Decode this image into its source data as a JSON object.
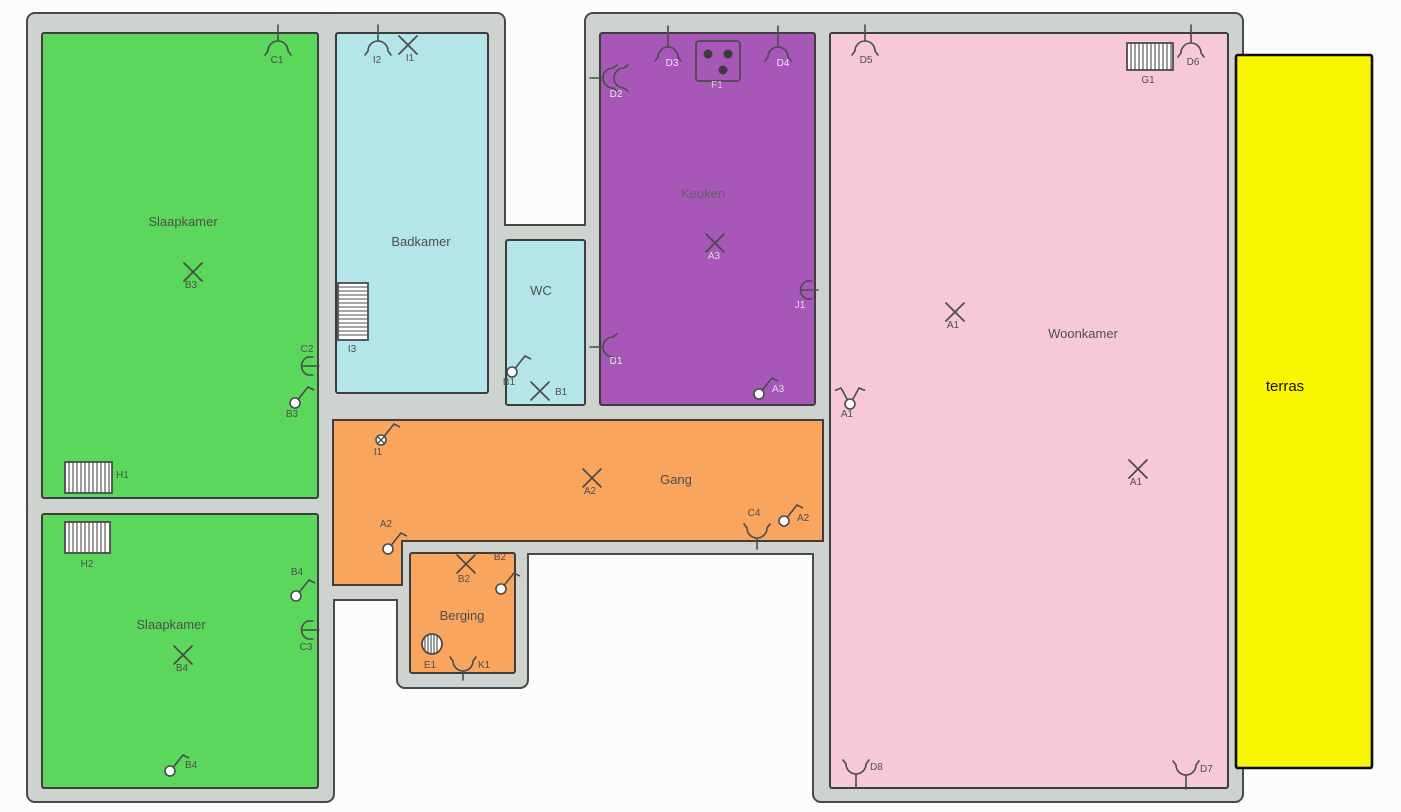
{
  "plan": {
    "title": "floor-plan",
    "colors": {
      "wall": "#cfd3cf",
      "wallStroke": "#4a4a45",
      "roomStroke": "#3d3d3d",
      "green": "#5bd75b",
      "cyan": "#b4e5e9",
      "purple": "#a757b7",
      "pink": "#f6c8d8",
      "orange": "#f9a55e",
      "yellow": "#f8f500",
      "symbol": "#4b4b4b",
      "label": "#4f4f4f"
    },
    "walls": [
      {
        "x": 28,
        "y": 14,
        "w": 305,
        "h": 497
      },
      {
        "x": 322,
        "y": 14,
        "w": 182,
        "h": 395
      },
      {
        "x": 494,
        "y": 226,
        "w": 104,
        "h": 193
      },
      {
        "x": 320,
        "y": 406,
        "w": 518,
        "h": 147
      },
      {
        "x": 320,
        "y": 500,
        "w": 96,
        "h": 99
      },
      {
        "x": 398,
        "y": 539,
        "w": 129,
        "h": 148
      },
      {
        "x": 28,
        "y": 500,
        "w": 305,
        "h": 301
      },
      {
        "x": 586,
        "y": 14,
        "w": 258,
        "h": 407
      },
      {
        "x": 814,
        "y": 14,
        "w": 428,
        "h": 787
      }
    ],
    "rooms": [
      {
        "id": "slaapkamer-1",
        "label": "Slaapkamer",
        "shape": "rect",
        "x": 42,
        "y": 33,
        "w": 276,
        "h": 465,
        "fill": "green",
        "lx": 183,
        "ly": 226
      },
      {
        "id": "badkamer",
        "label": "Badkamer",
        "shape": "rect",
        "x": 336,
        "y": 33,
        "w": 152,
        "h": 360,
        "fill": "cyan",
        "lx": 421,
        "ly": 246
      },
      {
        "id": "wc",
        "label": "WC",
        "shape": "rect",
        "x": 506,
        "y": 240,
        "w": 79,
        "h": 165,
        "fill": "cyan",
        "lx": 541,
        "ly": 295
      },
      {
        "id": "keuken",
        "label": "Keuken",
        "shape": "rect",
        "x": 600,
        "y": 33,
        "w": 215,
        "h": 372,
        "fill": "purple",
        "lx": 703,
        "ly": 198,
        "lc": "#616161"
      },
      {
        "id": "woonkamer",
        "label": "Woonkamer",
        "shape": "rect",
        "x": 830,
        "y": 33,
        "w": 398,
        "h": 755,
        "fill": "pink",
        "lx": 1083,
        "ly": 338
      },
      {
        "id": "gang",
        "label": "Gang",
        "shape": "poly",
        "points": "333,420 823,420 823,541 402,541 402,585 333,585",
        "fill": "orange",
        "lx": 676,
        "ly": 484
      },
      {
        "id": "berging",
        "label": "Berging",
        "shape": "rect",
        "x": 410,
        "y": 553,
        "w": 105,
        "h": 120,
        "fill": "orange",
        "lx": 462,
        "ly": 620
      },
      {
        "id": "slaapkamer-2",
        "label": "Slaapkamer",
        "shape": "rect",
        "x": 42,
        "y": 514,
        "w": 276,
        "h": 274,
        "fill": "green",
        "lx": 171,
        "ly": 629
      },
      {
        "id": "terras",
        "label": "terras",
        "shape": "rect",
        "x": 1236,
        "y": 55,
        "w": 136,
        "h": 713,
        "fill": "yellow",
        "stroke": "#0d0d0d",
        "sw": 2.6,
        "lx": 1285,
        "ly": 391,
        "fs": 15,
        "lc": "#111111"
      }
    ],
    "symbols": [
      {
        "t": "ceiling-lamp",
        "x": 278,
        "y": 49,
        "stem": 16,
        "label": "C1",
        "lx": 277,
        "ly": 63
      },
      {
        "t": "lamp-x",
        "x": 193,
        "y": 272,
        "label": "B3",
        "lx": 191,
        "ly": 288
      },
      {
        "t": "socket",
        "x": 305,
        "y": 366,
        "label": "C2",
        "lx": 307,
        "ly": 352
      },
      {
        "t": "switch",
        "x": 295,
        "y": 403,
        "label": "B3",
        "lx": 292,
        "ly": 417
      },
      {
        "t": "radiator",
        "x": 65,
        "y": 462,
        "w": 47,
        "h": 31,
        "hatch": "v",
        "label": "H1",
        "lx": 116,
        "ly": 478,
        "anchor": "start"
      },
      {
        "t": "ceiling-lamp",
        "x": 378,
        "y": 49,
        "stem": 16,
        "label": "I2",
        "lx": 377,
        "ly": 63
      },
      {
        "t": "lamp-x",
        "x": 408,
        "y": 45,
        "label": "I1",
        "lx": 410,
        "ly": 61
      },
      {
        "t": "radiator",
        "x": 338,
        "y": 283,
        "w": 30,
        "h": 57,
        "hatch": "h",
        "label": "I3",
        "lx": 352,
        "ly": 352
      },
      {
        "t": "switch",
        "x": 512,
        "y": 372,
        "label": "B1",
        "lx": 509,
        "ly": 385
      },
      {
        "t": "lamp-x",
        "x": 540,
        "y": 391,
        "label": "B1",
        "lx": 555,
        "ly": 395,
        "anchor": "start"
      },
      {
        "t": "wall-lamp-double",
        "x": 611,
        "y": 78,
        "rot": -90,
        "label": "D2",
        "lx": 616,
        "ly": 97,
        "lc": "#e9e9e9"
      },
      {
        "t": "ceiling-lamp",
        "x": 668,
        "y": 55,
        "stem": 21,
        "label": "D3",
        "lx": 672,
        "ly": 66,
        "lc": "#e9e9e9"
      },
      {
        "t": "cooktop",
        "x": 696,
        "y": 41,
        "w": 44,
        "h": 40,
        "label": "F1",
        "lx": 717,
        "ly": 88,
        "lc": "#cfcfcf"
      },
      {
        "t": "ceiling-lamp",
        "x": 778,
        "y": 55,
        "stem": 21,
        "label": "D4",
        "lx": 783,
        "ly": 66,
        "lc": "#e9e9e9"
      },
      {
        "t": "lamp-x",
        "x": 715,
        "y": 243,
        "label": "A3",
        "lx": 714,
        "ly": 259,
        "lc": "#dcdcdc"
      },
      {
        "t": "socket",
        "x": 804,
        "y": 290,
        "label": "J1",
        "lx": 800,
        "ly": 308,
        "lc": "#dcdcdc"
      },
      {
        "t": "wall-lamp",
        "x": 611,
        "y": 347,
        "rot": -90,
        "label": "D1",
        "lx": 616,
        "ly": 364,
        "lc": "#e9e9e9"
      },
      {
        "t": "switch",
        "x": 759,
        "y": 394,
        "label": "A3",
        "lx": 772,
        "ly": 392,
        "anchor": "start",
        "lc": "#dcdcdc"
      },
      {
        "t": "ceiling-lamp",
        "x": 865,
        "y": 49,
        "stem": 16,
        "label": "D5",
        "lx": 866,
        "ly": 63
      },
      {
        "t": "radiator",
        "x": 1127,
        "y": 43,
        "w": 46,
        "h": 27,
        "hatch": "v",
        "label": "G1",
        "lx": 1148,
        "ly": 83
      },
      {
        "t": "ceiling-lamp",
        "x": 1191,
        "y": 51,
        "stem": 18,
        "label": "D6",
        "lx": 1193,
        "ly": 65
      },
      {
        "t": "lamp-x",
        "x": 955,
        "y": 312,
        "label": "A1",
        "lx": 953,
        "ly": 328
      },
      {
        "t": "switch-double",
        "x": 850,
        "y": 404,
        "label": "A1",
        "lx": 847,
        "ly": 417
      },
      {
        "t": "lamp-x",
        "x": 1138,
        "y": 469,
        "label": "A1",
        "lx": 1136,
        "ly": 485
      },
      {
        "t": "wall-lamp",
        "x": 856,
        "y": 766,
        "rot": 180,
        "stem": 14,
        "label": "D8",
        "lx": 870,
        "ly": 770,
        "anchor": "start"
      },
      {
        "t": "wall-lamp",
        "x": 1186,
        "y": 767,
        "rot": 180,
        "stem": 14,
        "label": "D7",
        "lx": 1200,
        "ly": 772,
        "anchor": "start"
      },
      {
        "t": "switch-x",
        "x": 381,
        "y": 440,
        "label": "I1",
        "lx": 378,
        "ly": 455
      },
      {
        "t": "lamp-x",
        "x": 592,
        "y": 478,
        "label": "A2",
        "lx": 590,
        "ly": 494
      },
      {
        "t": "wall-lamp",
        "x": 757,
        "y": 530,
        "rot": 180,
        "stem": 11,
        "label": "C4",
        "lx": 754,
        "ly": 516
      },
      {
        "t": "switch",
        "x": 784,
        "y": 521,
        "label": "A2",
        "lx": 797,
        "ly": 521,
        "anchor": "start"
      },
      {
        "t": "switch",
        "x": 388,
        "y": 549,
        "label": "A2",
        "lx": 386,
        "ly": 527
      },
      {
        "t": "lamp-x",
        "x": 466,
        "y": 564,
        "label": "B2",
        "lx": 464,
        "ly": 582
      },
      {
        "t": "switch",
        "x": 501,
        "y": 589,
        "label": "B2",
        "lx": 500,
        "ly": 560
      },
      {
        "t": "boiler",
        "x": 432,
        "y": 644,
        "r": 10,
        "label": "E1",
        "lx": 430,
        "ly": 668
      },
      {
        "t": "wall-lamp",
        "x": 463,
        "y": 663,
        "rot": 180,
        "stem": 9,
        "label": "K1",
        "lx": 478,
        "ly": 668,
        "anchor": "start"
      },
      {
        "t": "radiator",
        "x": 65,
        "y": 522,
        "w": 45,
        "h": 31,
        "hatch": "v",
        "label": "H2",
        "lx": 87,
        "ly": 567
      },
      {
        "t": "switch",
        "x": 296,
        "y": 596,
        "label": "B4",
        "lx": 297,
        "ly": 575
      },
      {
        "t": "socket",
        "x": 305,
        "y": 630,
        "label": "C3",
        "lx": 306,
        "ly": 650
      },
      {
        "t": "lamp-x",
        "x": 183,
        "y": 655,
        "label": "B4",
        "lx": 182,
        "ly": 671
      },
      {
        "t": "switch",
        "x": 170,
        "y": 771,
        "label": "B4",
        "lx": 185,
        "ly": 768,
        "anchor": "start"
      }
    ]
  }
}
